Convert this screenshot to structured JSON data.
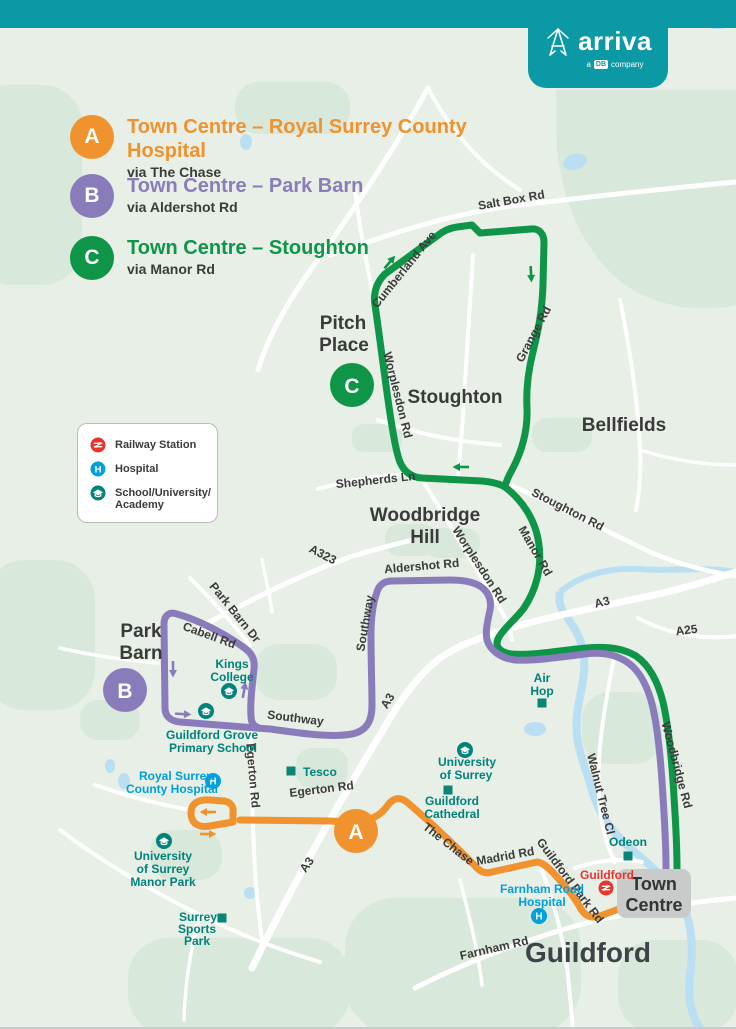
{
  "brand": {
    "name": "arriva",
    "tagline_a": "a",
    "tagline_db": "DB",
    "tagline_company": "company"
  },
  "routes": [
    {
      "id": "A",
      "title": "Town Centre – Royal Surrey County Hospital",
      "via": "via The Chase",
      "color": "#F0922D"
    },
    {
      "id": "B",
      "title": "Town Centre – Park Barn",
      "via": "via Aldershot Rd",
      "color": "#8A7CBB"
    },
    {
      "id": "C",
      "title": "Town Centre – Stoughton",
      "via": "via Manor Rd",
      "color": "#0E9548"
    }
  ],
  "map_key": {
    "railway": "Railway Station",
    "hospital": "Hospital",
    "school_line1": "School/University/",
    "school_line2": "Academy"
  },
  "map": {
    "roads": {
      "salt_box_rd": "Salt Box Rd",
      "cumberland_ave": "Cumberland Ave",
      "grange_rd": "Grange Rd",
      "shepherds_ln": "Shepherds Ln",
      "stoughton_rd": "Stoughton Rd",
      "manor_rd": "Manor Rd",
      "worplesdon_rd": "Worplesdon Rd",
      "aldershot_rd": "Aldershot Rd",
      "a323": "A323",
      "a3": "A3",
      "a25": "A25",
      "woodbridge_rd": "Woodbridge Rd",
      "walnut_tree_cl": "Walnut Tree Cl",
      "southway": "Southway",
      "park_barn_dr": "Park Barn Dr",
      "cabell_rd": "Cabell Rd",
      "egerton_rd": "Egerton Rd",
      "the_chase": "The Chase",
      "madrid_rd": "Madrid Rd",
      "guildford_park_rd": "Guildford Park Rd",
      "farnham_rd": "Farnham Rd"
    },
    "places": {
      "pitch_place_1": "Pitch",
      "pitch_place_2": "Place",
      "stoughton": "Stoughton",
      "bellfields": "Bellfields",
      "woodbridge_hill_1": "Woodbridge",
      "woodbridge_hill_2": "Hill",
      "park_barn_1": "Park",
      "park_barn_2": "Barn",
      "guildford": "Guildford",
      "town_centre_1": "Town",
      "town_centre_2": "Centre"
    },
    "pois": {
      "royal_surrey_1": "Royal Surrey",
      "royal_surrey_2": "County Hospital",
      "farnham_hospital_1": "Farnham Road",
      "farnham_hospital_2": "Hospital",
      "guildford_station": "Guildford",
      "odeon": "Odeon",
      "tesco": "Tesco",
      "air_hop_1": "Air",
      "air_hop_2": "Hop",
      "uni_surrey_1": "University",
      "uni_surrey_2": "of Surrey",
      "cathedral_1": "Guildford",
      "cathedral_2": "Cathedral",
      "kings_1": "Kings",
      "kings_2": "College",
      "grove_1": "Guildford Grove",
      "grove_2": "Primary School",
      "manor_park_1": "University",
      "manor_park_2": "of Surrey",
      "manor_park_3": "Manor Park",
      "sports_1": "Surrey",
      "sports_2": "Sports",
      "sports_3": "Park",
      "hospital_h": "H"
    }
  },
  "colors": {
    "brand_teal": "#0B99A5",
    "route_a": "#F0922D",
    "route_b": "#8A7CBB",
    "route_c": "#0E9548",
    "poi_teal": "#00837B",
    "hospital_blue": "#00A0DF",
    "rail_red": "#E8342C",
    "town_centre_box": "#C9CACA",
    "water": "#BADFF2",
    "road_label": "#3B3B3A",
    "map_background": "#E7EFE6"
  }
}
